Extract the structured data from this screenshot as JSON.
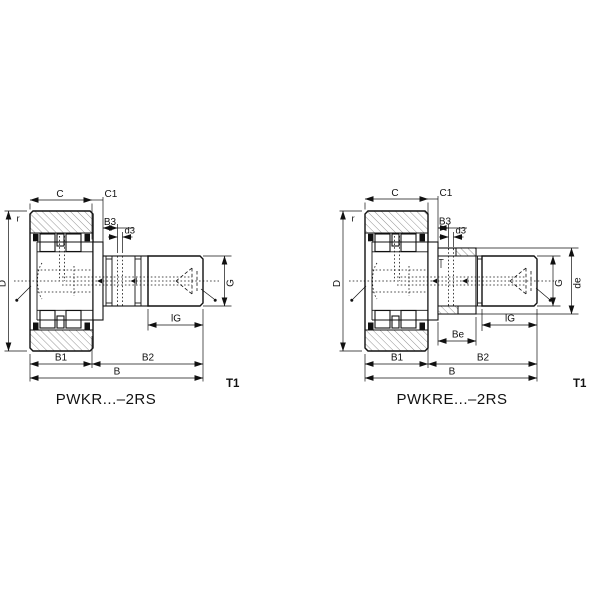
{
  "page": {
    "background": "#ffffff",
    "ink": "#111111"
  },
  "figures": [
    {
      "id": "PWKR",
      "title": "PWKR...–2RS",
      "note": "T1",
      "labels": {
        "C": "C",
        "C1": "C1",
        "B3": "B3",
        "d3": "d3",
        "r": "r",
        "D": "D",
        "G": "G",
        "lG": "lG",
        "B1": "B1",
        "B2": "B2",
        "B": "B"
      }
    },
    {
      "id": "PWKRE",
      "title": "PWKRE...–2RS",
      "note": "T1",
      "labels": {
        "C": "C",
        "C1": "C1",
        "B3": "B3",
        "d3": "d3",
        "r": "r",
        "D": "D",
        "G": "G",
        "de": "de",
        "lG": "lG",
        "Be": "Be",
        "B1": "B1",
        "B2": "B2",
        "B": "B"
      }
    }
  ]
}
